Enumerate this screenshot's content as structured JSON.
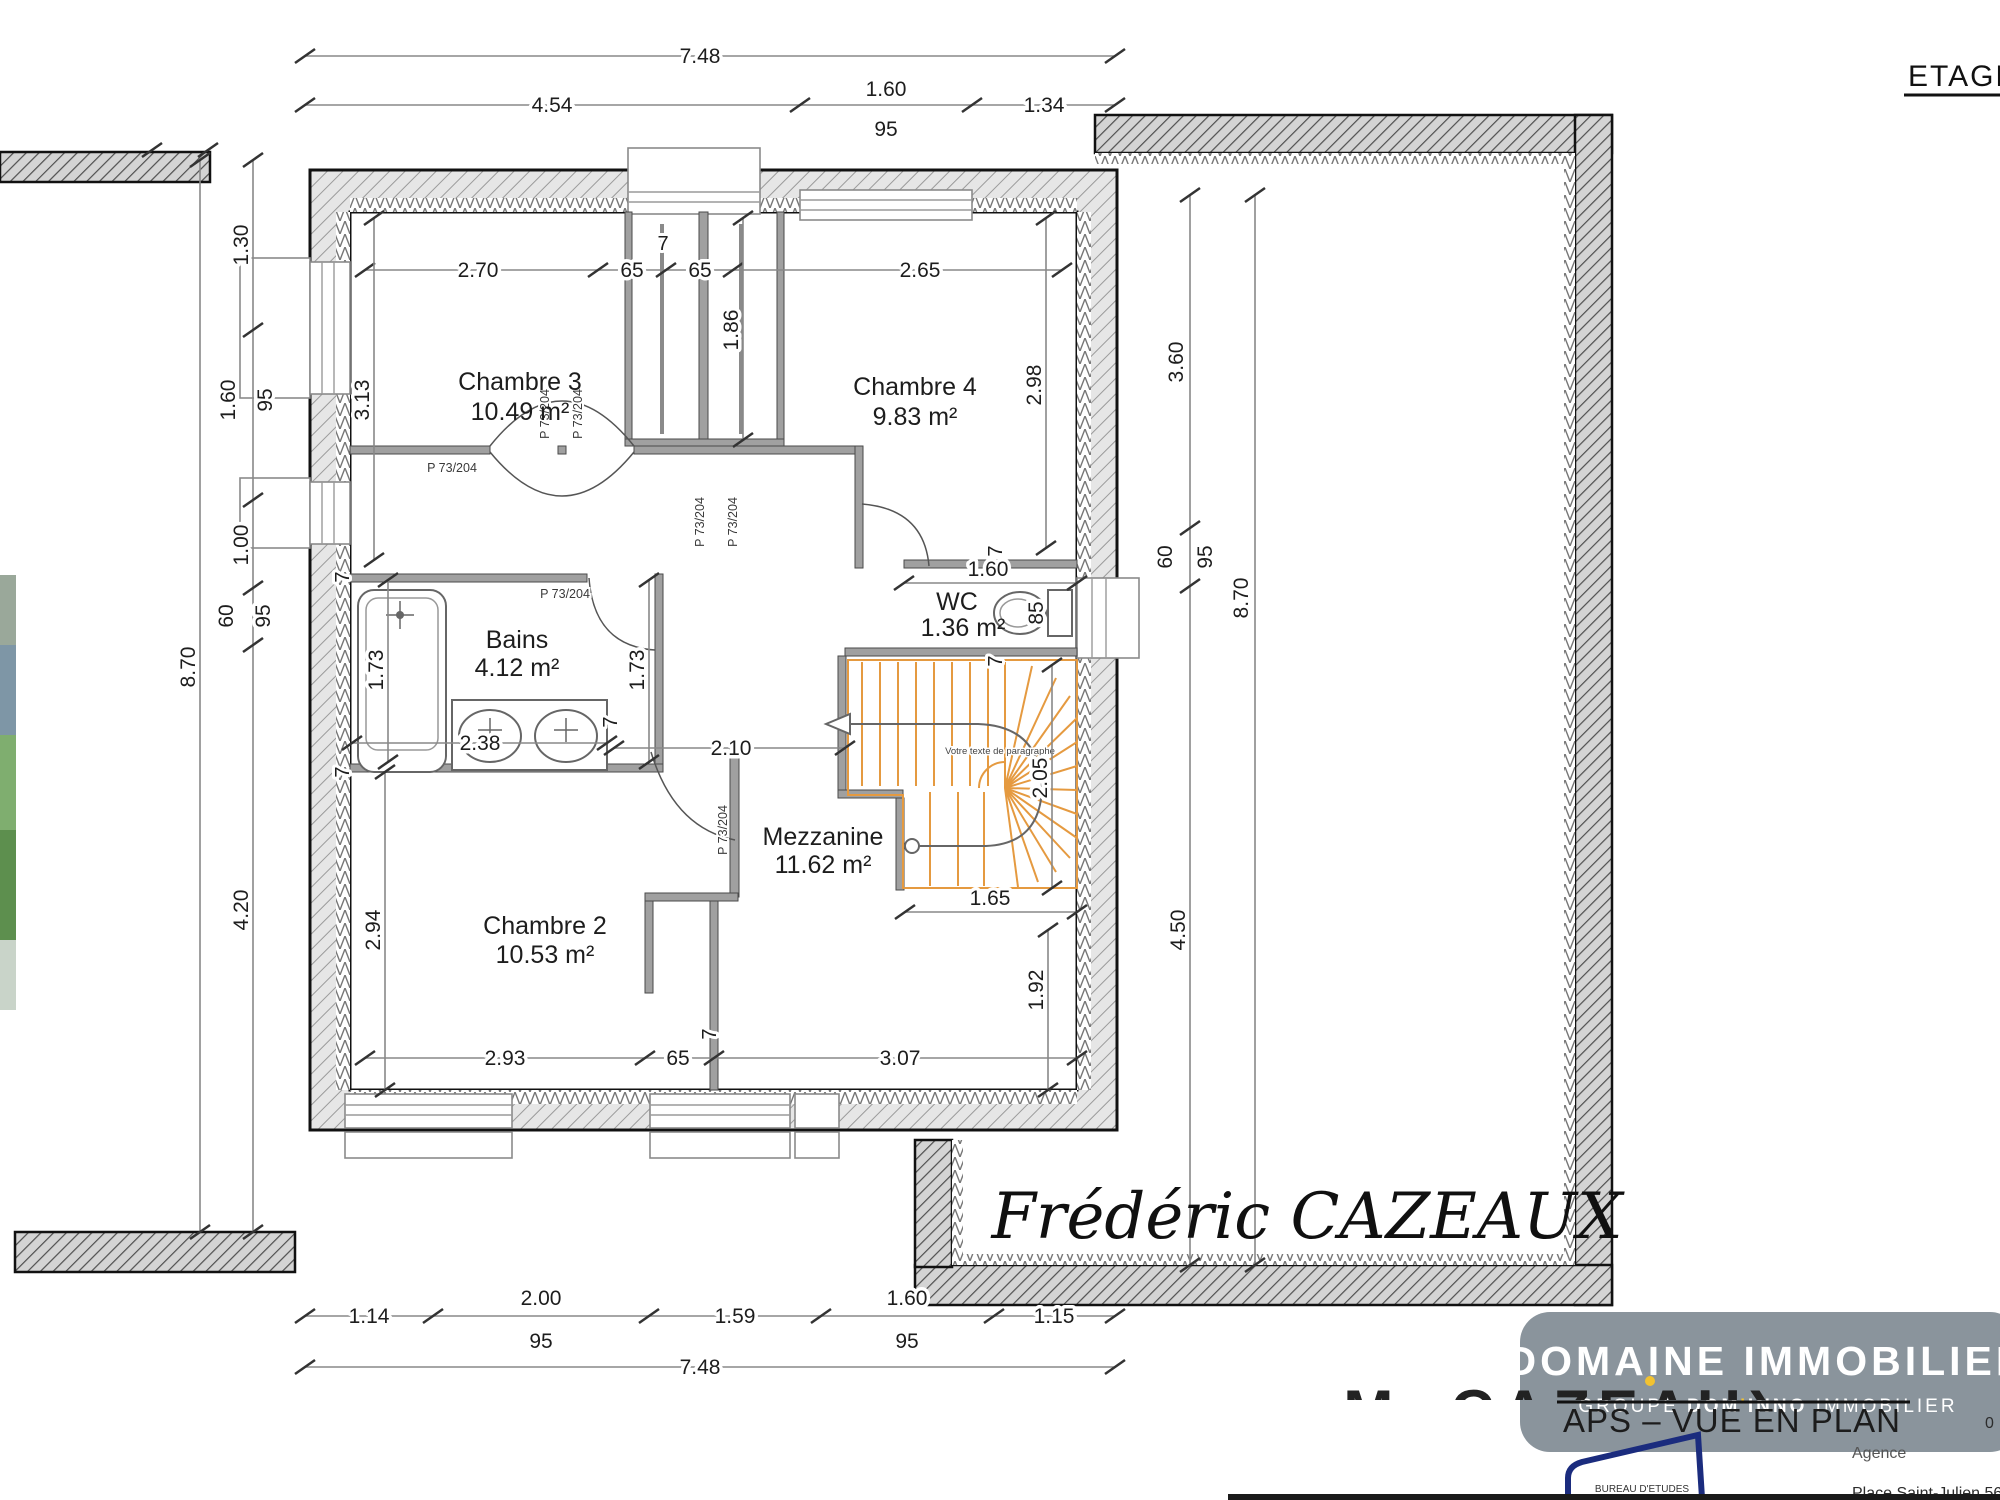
{
  "header": {
    "etage": "ETAGE"
  },
  "rooms": {
    "chambre3": {
      "name": "Chambre 3",
      "area": "10.49 m²"
    },
    "chambre4": {
      "name": "Chambre 4",
      "area": "9.83 m²"
    },
    "bains": {
      "name": "Bains",
      "area": "4.12 m²"
    },
    "wc": {
      "name": "WC",
      "area": "1.36 m²"
    },
    "mezzanine": {
      "name": "Mezzanine",
      "area": "11.62 m²"
    },
    "chambre2": {
      "name": "Chambre 2",
      "area": "10.53 m²"
    }
  },
  "doors": {
    "label": "P 73/204"
  },
  "stairs": {
    "note": "Votre texte de paragraphe"
  },
  "dims": {
    "top": {
      "total": "7.48",
      "a": "4.54",
      "b": "1.60",
      "b_sill": "95",
      "c": "1.34"
    },
    "bottom": {
      "total": "7.48",
      "a": "1.14",
      "b": "2.00",
      "b_sill": "95",
      "c": "1.59",
      "d": "1.60",
      "d_sill": "95",
      "e": "1.15"
    },
    "left": {
      "overall": "8.70",
      "a": "1.30",
      "b": "1.60",
      "b_sill": "95",
      "c": "1.00",
      "d": "60",
      "d_sill": "95",
      "e": "4.20"
    },
    "right": {
      "overall": "8.70",
      "a": "3.60",
      "b": "60",
      "b_sill": "95",
      "c": "4.50"
    },
    "interior": {
      "ch3_w": "2.70",
      "closet_a": "65",
      "closet_b": "65",
      "ch4_w": "2.65",
      "wall": "7",
      "closet_d": "1.86",
      "ch3_h": "3.13",
      "ch4_h": "2.98",
      "bains_w": "2.38",
      "bains_h": "1.73",
      "hall_w": "2.10",
      "wc_w": "1.60",
      "wc_d": "85",
      "stair_h": "2.05",
      "stair_w": "1.65",
      "ch2_h": "2.94",
      "ch2_a": "2.93",
      "ch2_b": "65",
      "bot_c": "3.07",
      "right_h": "1.92"
    }
  },
  "branding": {
    "signature": "Frédéric CAZEAUX",
    "partial_name": "M. CAZEAUX",
    "logo_line1": "DOMAINE IMMOBILIER",
    "logo_groupe": "GROUPE ",
    "logo_brand_pre": "DOM",
    "logo_brand_apos": "'",
    "logo_brand_post": "INNO",
    "logo_suffix": " IMMOBILIER",
    "doc_title": "APS – VUE EN PLAN",
    "bureau": "BUREAU D'ETUDES",
    "agence_label": "Agence",
    "address": "Place Saint-Julien 56 190",
    "phone_partial": "0"
  },
  "colors": {
    "stair_orange": "#E59A40",
    "logo_gray": "#8A949C",
    "logo_yellow": "#F2C230",
    "bureau_blue": "#1B2C7E"
  }
}
